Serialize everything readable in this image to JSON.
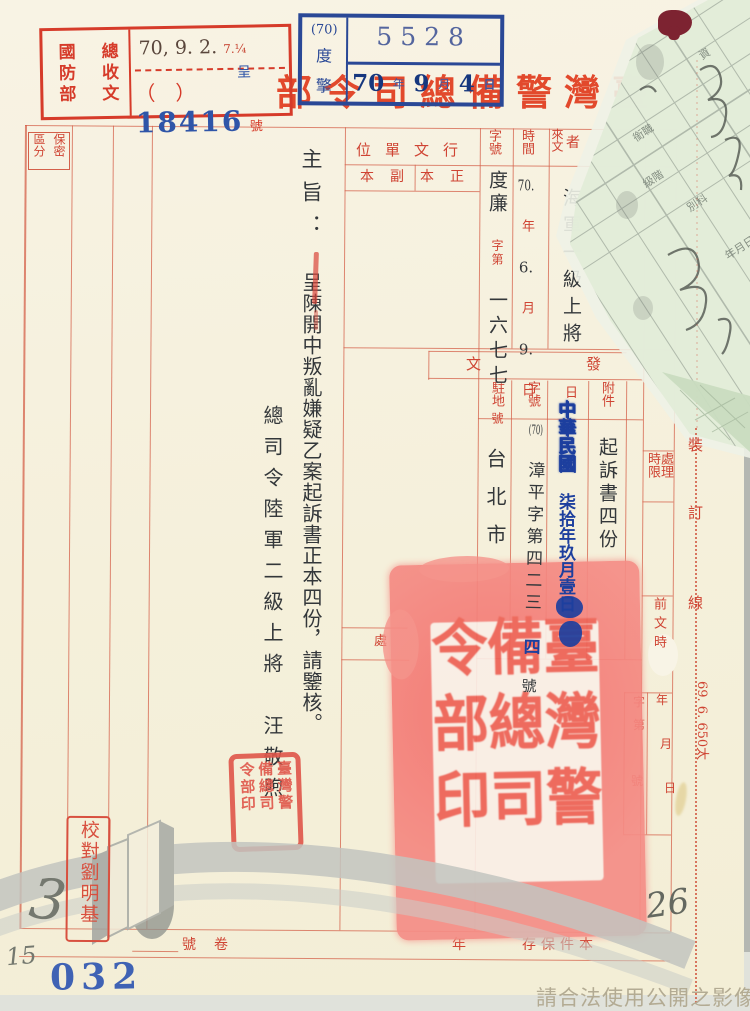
{
  "colors": {
    "red_ink": "#cf4433",
    "blue_ink": "#2a4896",
    "seal_pink": "#f4837c"
  },
  "title_display": "部令司總備警灣臺",
  "received_stamp": {
    "org": "國防部",
    "unit": "總收文",
    "date_main": "70, 9. 2.",
    "date_small": "7.¼",
    "paren": "（　）",
    "cheng": "呈",
    "number": "18416",
    "hao": "號"
  },
  "registry_stamp": {
    "code": "(70)",
    "c1": "度",
    "c2": "擎",
    "number": "5528",
    "y": "70",
    "y_l": "年",
    "m": "9",
    "m_l": "月",
    "d": "4",
    "d_l": "日"
  },
  "security_box": {
    "left": "區分",
    "right": "保密"
  },
  "headers": {
    "xingwen": "位單文行",
    "copy_left": "本副",
    "copy_right": "本正",
    "zihao": "字號",
    "time": "時間",
    "laiwen": "來文",
    "zhe": "者",
    "fa_l": "文",
    "fa_r": "發",
    "zhudi": "駐地",
    "zihao2": "字號",
    "ri": "日",
    "fujian": "附件",
    "chu": "處",
    "chuli": "處理",
    "shixian": "時限",
    "qianwen": "前文時",
    "zi": "字",
    "di": "第",
    "hao": "號",
    "nian2": "年",
    "yue2": "月",
    "ri2": "日",
    "bind1": "裝",
    "bind2": "訂",
    "bind3": "線",
    "print_code": "69. 6. 650太",
    "b_hao": "號",
    "b_juan": "卷",
    "b_nian": "年",
    "b_cun": "存保件本"
  },
  "laiwen": {
    "unit": "度廉",
    "zidi": "字第",
    "num": "一六七七",
    "hao": "號",
    "ty": "70.",
    "tyl": "年",
    "tm": "6.",
    "tml": "月",
    "td": "9.",
    "tdl": "日",
    "sender": "海軍一級上將"
  },
  "fawen": {
    "zhudi": "台北市",
    "code": "(70)",
    "num": "漳平字第四二三",
    "num_blue": "四",
    "hao": "號",
    "date_a": "中華民國",
    "date_b": "柒拾年玖月壹日",
    "fujian": "起訴書四份"
  },
  "subject": {
    "label": "主旨：",
    "text": "呈陳開中叛亂嫌疑乙案起訴書正本四份，請鑒核。"
  },
  "signature": {
    "title": "總司令陸軍二級上將",
    "name": "汪敬煦"
  },
  "seals": {
    "big": [
      "臺灣警",
      "備總司",
      "令部印"
    ],
    "small": [
      "臺灣警",
      "備總司",
      "令部印"
    ],
    "proof": "校對劉明基"
  },
  "slip_labels": {
    "a": "資",
    "b": "銜職",
    "c": "級階",
    "d": "別科",
    "e": "年月日"
  },
  "annotations": {
    "p3": "3",
    "p15": "15",
    "p26": "26",
    "b032": "032"
  },
  "watermark": "請合法使用公開之影像"
}
